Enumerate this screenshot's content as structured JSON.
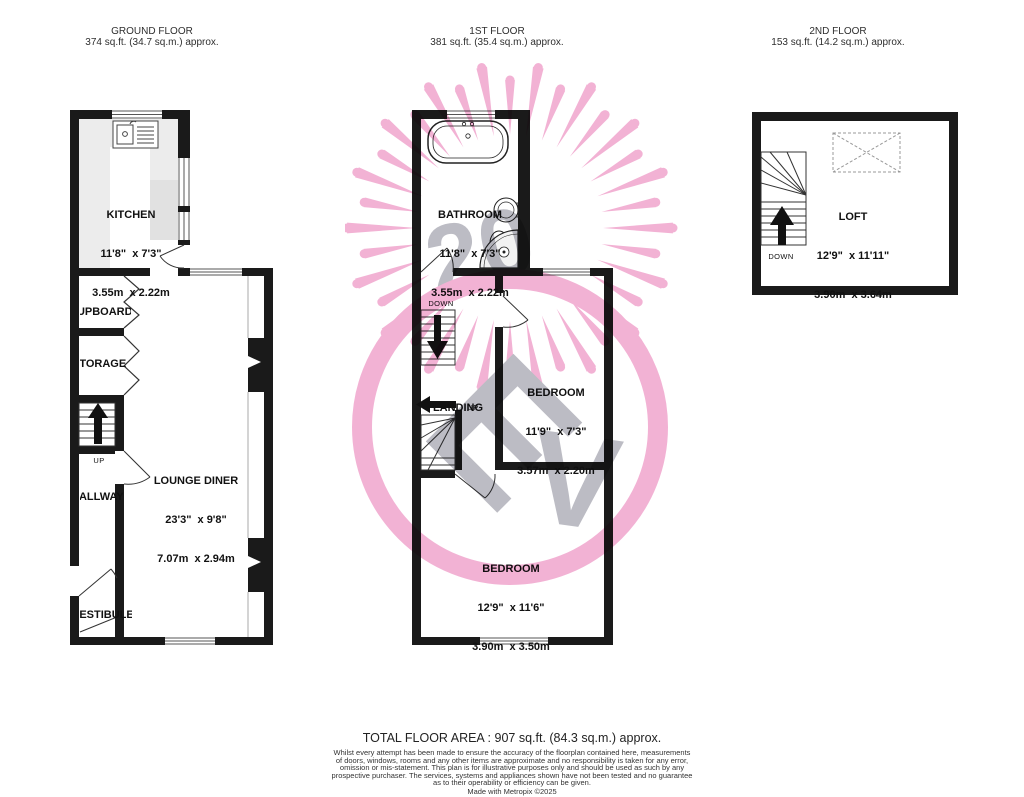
{
  "floors": {
    "ground": {
      "title": "GROUND FLOOR",
      "area": "374 sq.ft. (34.7 sq.m.) approx."
    },
    "first": {
      "title": "1ST FLOOR",
      "area": "381 sq.ft. (35.4 sq.m.) approx."
    },
    "second": {
      "title": "2ND FLOOR",
      "area": "153 sq.ft. (14.2 sq.m.) approx."
    }
  },
  "rooms": {
    "kitchen": {
      "name": "KITCHEN",
      "imperial": "11'8\"  x 7'3\"",
      "metric": "3.55m  x 2.22m"
    },
    "lounge": {
      "name": "LOUNGE DINER",
      "imperial": "23'3\"  x 9'8\"",
      "metric": "7.07m  x 2.94m"
    },
    "cupboard": {
      "name": "CUPBOARD"
    },
    "storage": {
      "name": "STORAGE"
    },
    "hallway": {
      "name": "HALLWAY"
    },
    "vestibule": {
      "name": "VESTIBULE"
    },
    "bathroom": {
      "name": "BATHROOM",
      "imperial": "11'8\"  x 7'3\"",
      "metric": "3.55m  x 2.22m"
    },
    "landing": {
      "name": "LANDING"
    },
    "bedroom1": {
      "name": "BEDROOM",
      "imperial": "11'9\"  x 7'3\"",
      "metric": "3.57m  x 2.20m"
    },
    "bedroom2": {
      "name": "BEDROOM",
      "imperial": "12'9\"  x 11'6\"",
      "metric": "3.90m  x 3.50m"
    },
    "loft": {
      "name": "LOFT",
      "imperial": "12'9\"  x 11'11\"",
      "metric": "3.90m  x 3.64m"
    }
  },
  "stair_labels": {
    "up": "UP",
    "down": "DOWN"
  },
  "footer": {
    "total": "TOTAL FLOOR AREA : 907 sq.ft. (84.3 sq.m.) approx.",
    "disclaimer": [
      "Whilst every attempt has been made to ensure the accuracy of the floorplan contained here, measurements",
      "of doors, windows, rooms and any other items are approximate and no responsibility is taken for any error,",
      "omission or mis-statement. This plan is for illustrative purposes only and should be used as such by any",
      "prospective purchaser. The services, systems and appliances shown have not been tested and no guarantee",
      "as to their operability or efficiency can be given."
    ],
    "credit": "Made with Metropix ©2025"
  },
  "colors": {
    "wall": "#1a1a1a",
    "watermark_pink": "#f2aed2",
    "watermark_gray": "#b9b9c1"
  }
}
